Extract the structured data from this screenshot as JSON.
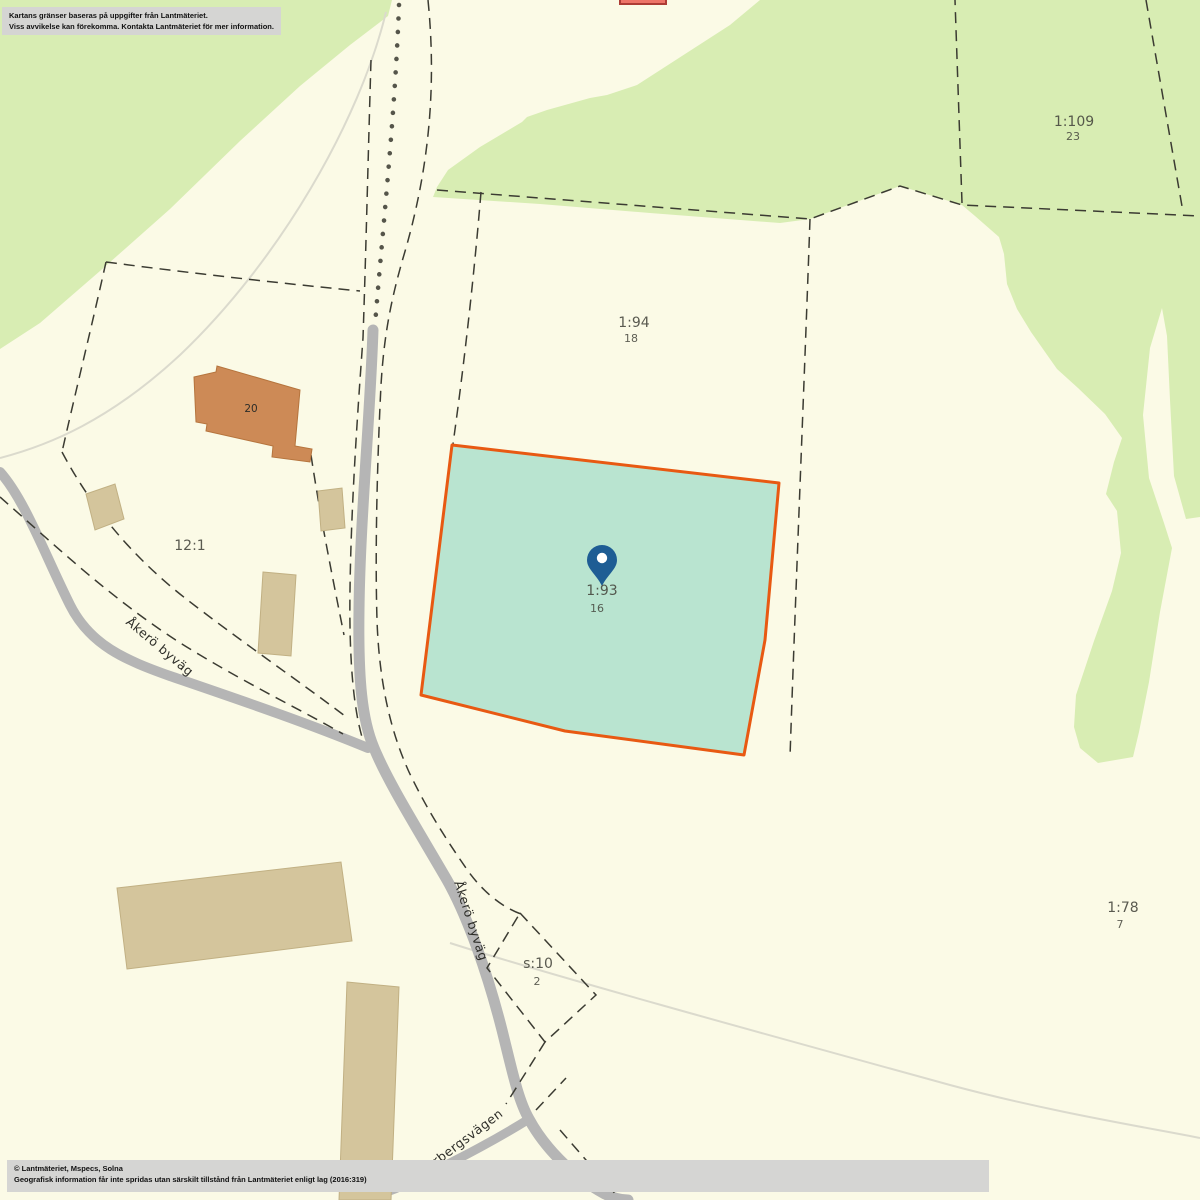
{
  "map": {
    "disclaimer": {
      "line1": "Kartans gränser baseras på uppgifter från Lantmäteriet.",
      "line2": "Viss avvikelse kan förekomma. Kontakta Lantmäteriet för mer information."
    },
    "attribution": {
      "line1": "© Lantmäteriet, Mspecs, Solna",
      "line2": "Geografisk information får inte spridas utan särskilt tillstånd från Lantmäteriet enligt lag (2016:319)"
    },
    "parcels": [
      {
        "id": "1:109",
        "sub": "23"
      },
      {
        "id": "1:94",
        "sub": "18"
      },
      {
        "id": "1:93",
        "sub": "16",
        "highlighted": true
      },
      {
        "id": "12:1",
        "sub": ""
      },
      {
        "id": "s:10",
        "sub": "2"
      },
      {
        "id": "1:78",
        "sub": "7"
      }
    ],
    "buildings": [
      {
        "label": "20",
        "type": "residential"
      }
    ],
    "roads": [
      {
        "name": "Åkerö byväg"
      },
      {
        "name": "Åkerö byväg"
      },
      {
        "name": "Norbergsvägen"
      }
    ],
    "marker": {
      "type": "location-pin"
    },
    "colors": {
      "background": "#fbfae6",
      "forest": "#d8edb3",
      "highlight_fill": "#b9e4d0",
      "highlight_border": "#e85912",
      "road": "#b5b5b5",
      "building": "#d4c59c",
      "building_residential": "#cd8a56",
      "building_red": "#ed7468",
      "pin": "#1e5d94"
    }
  }
}
